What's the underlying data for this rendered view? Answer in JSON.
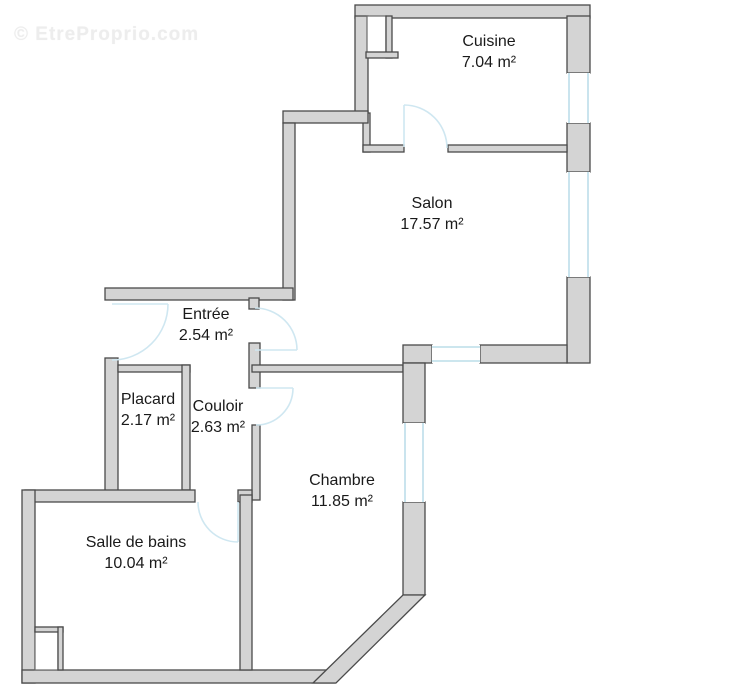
{
  "watermark": {
    "text": "© EtreProprio.com"
  },
  "rooms": {
    "cuisine": {
      "name": "Cuisine",
      "area": "7.04 m²"
    },
    "salon": {
      "name": "Salon",
      "area": "17.57 m²"
    },
    "entree": {
      "name": "Entrée",
      "area": "2.54 m²"
    },
    "placard": {
      "name": "Placard",
      "area": "2.17 m²"
    },
    "couloir": {
      "name": "Couloir",
      "area": "2.63 m²"
    },
    "chambre": {
      "name": "Chambre",
      "area": "11.85 m²"
    },
    "salle_de_bains": {
      "name": "Salle de bains",
      "area": "10.04 m²"
    }
  },
  "colors": {
    "wall_fill": "#d4d4d4",
    "wall_stroke": "#4a4a4a",
    "door": "#cfe7f1",
    "window_line": "#bcdde9",
    "text": "#1a1a1a",
    "watermark": "#ededed"
  }
}
